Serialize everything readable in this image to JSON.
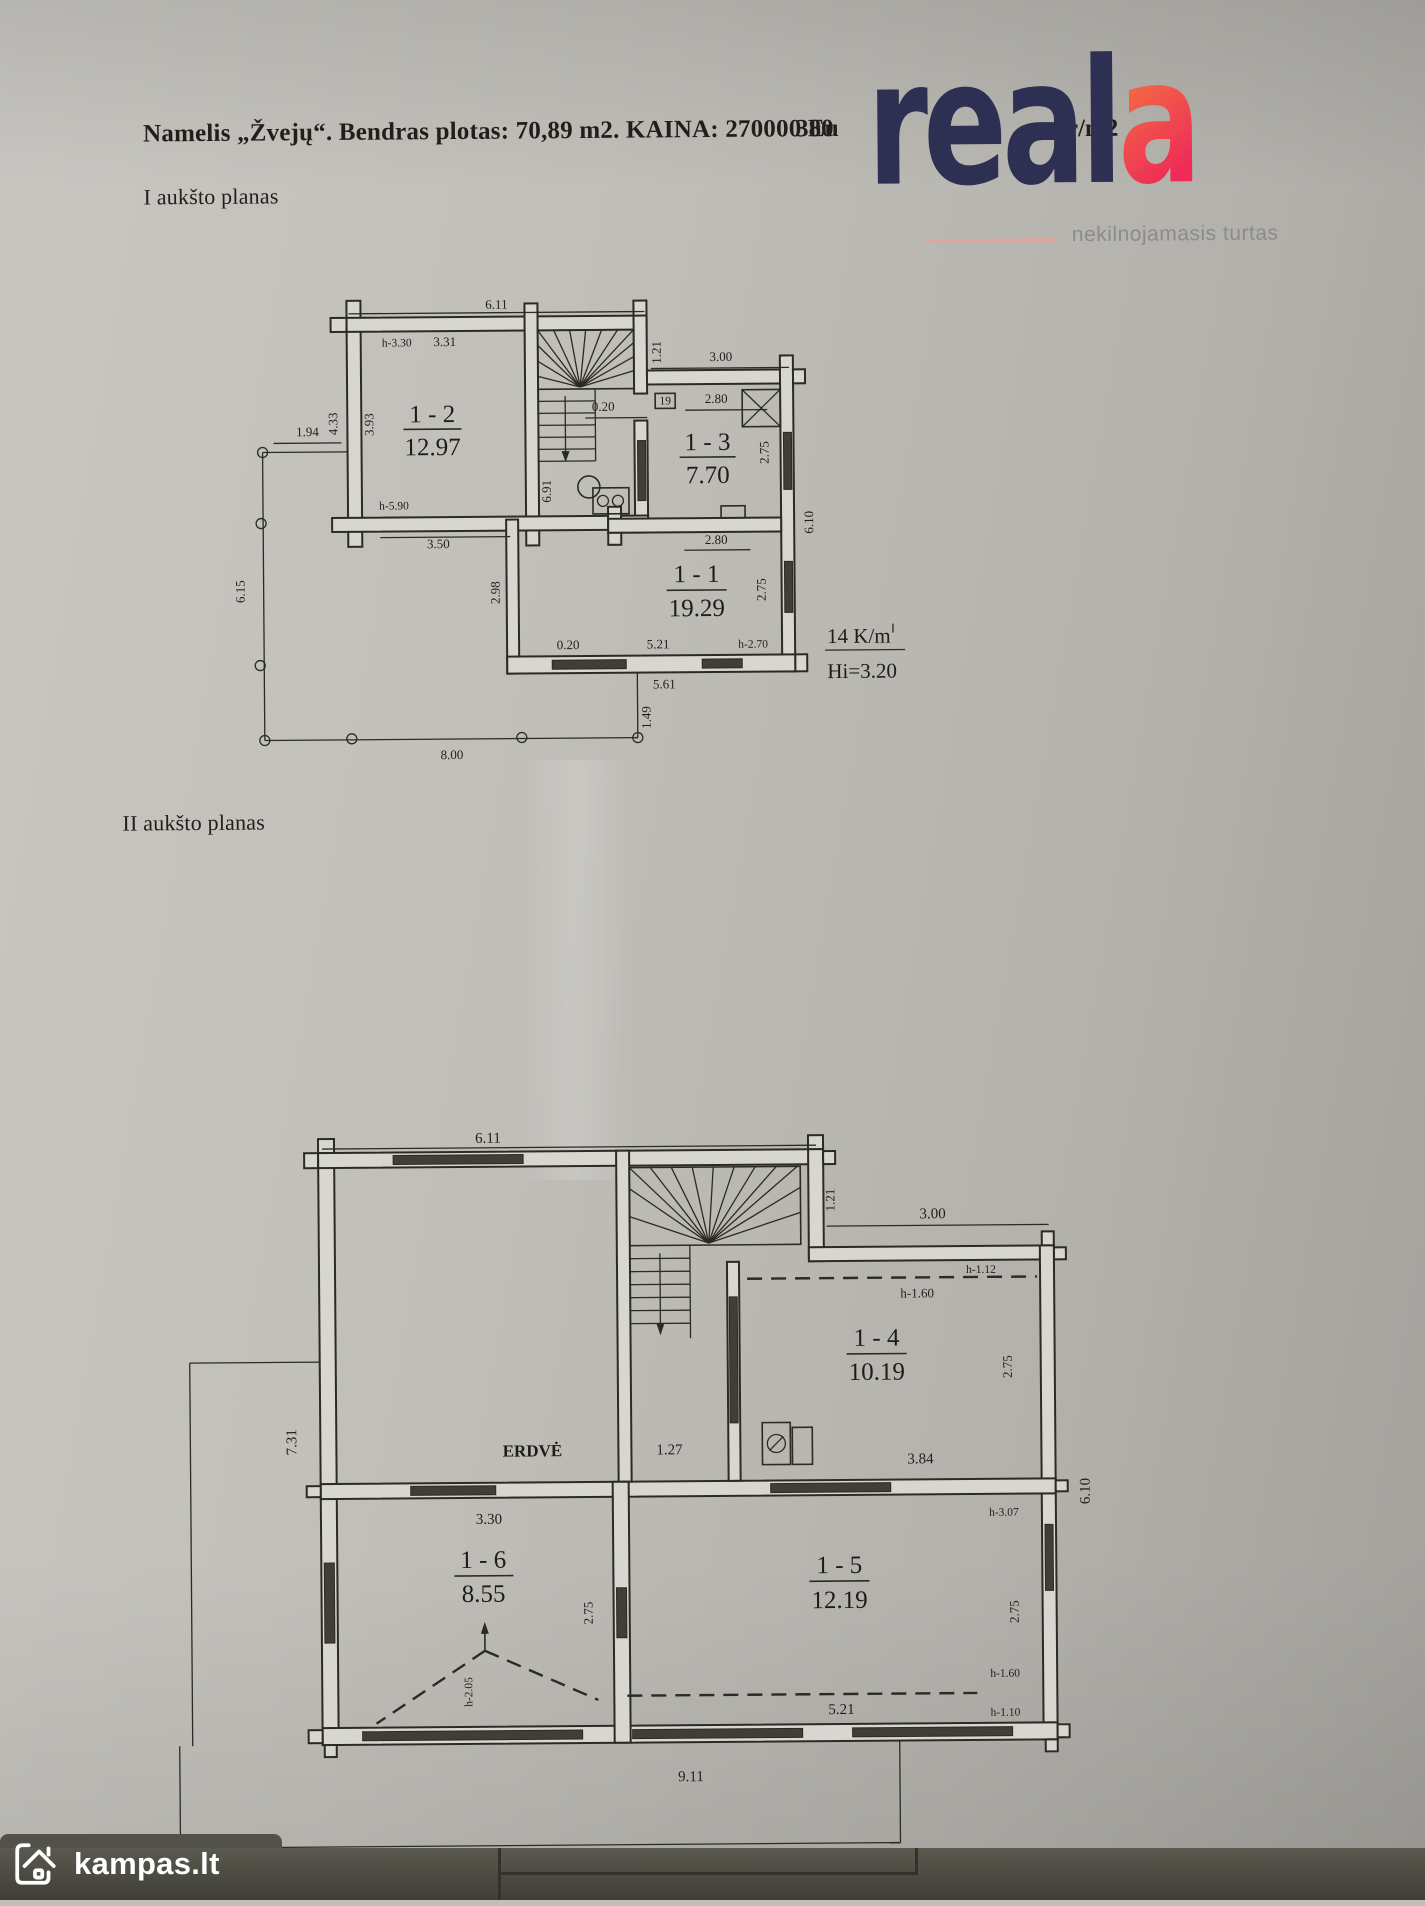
{
  "header": {
    "title": "Namelis „Žvejų“. Bendras plotas: 70,89 m2. KAINA: 270000 Eu",
    "price_fragment": "380",
    "unit_fragment": "ur/m2",
    "floor1_heading": "I aukšto planas",
    "floor2_heading": "II aukšto planas"
  },
  "branding": {
    "reala_main": "real",
    "reala_accent": "a",
    "tagline": "nekilnojamasis turtas",
    "kampas": "kampas.lt",
    "navy": "#2e3053",
    "accent_from": "#f5793f",
    "accent_to": "#ee2c57",
    "tagline_color": "#8c8b89"
  },
  "floor1": {
    "rooms": [
      {
        "id": "1 - 2",
        "area": "12.97"
      },
      {
        "id": "1 - 3",
        "area": "7.70"
      },
      {
        "id": "1 - 1",
        "area": "19.29"
      }
    ],
    "note_line1": "14 K/m",
    "note_line2": "Hi=3.20",
    "dims": {
      "top": "6.11",
      "r2_h": "h-3.30",
      "r2_w": "3.31",
      "p194": "1.94",
      "p433": "4.33",
      "p393": "3.93",
      "r2_h590": "h-5.90",
      "p350": "3.50",
      "deck_h": "6.15",
      "deck_w": "8.00",
      "st121": "1.21",
      "tr300": "3.00",
      "d020": "0.20",
      "r3_w": "2.80",
      "r3_h": "2.75",
      "door": "19",
      "i691": "6.91",
      "r610": "6.10",
      "i298": "2.98",
      "r1_w": "2.80",
      "r1_h": "2.75",
      "b020": "0.20",
      "b521": "5.21",
      "bh270": "h-2.70",
      "b561": "5.61",
      "d149": "1.49"
    }
  },
  "floor2": {
    "rooms": [
      {
        "id": "1 - 4",
        "area": "10.19"
      },
      {
        "id": "1 - 5",
        "area": "12.19"
      },
      {
        "id": "1 - 6",
        "area": "8.55"
      }
    ],
    "open_space": "ERDVĖ",
    "dims": {
      "top": "6.11",
      "st121": "1.21",
      "tr300": "3.00",
      "h112": "h-1.12",
      "h160": "h-1.60",
      "r4_h": "2.75",
      "r4_w": "3.84",
      "c127": "1.27",
      "l731": "7.31",
      "r610": "6.10",
      "r6_w": "3.30",
      "r6_h": "2.75",
      "r6_h205": "h-2.05",
      "r5_h307": "h-3.07",
      "r5_h": "2.75",
      "r5_h160": "h-1.60",
      "r5_h110": "h-1.10",
      "r5_w": "5.21",
      "deck_w": "9.11"
    }
  }
}
